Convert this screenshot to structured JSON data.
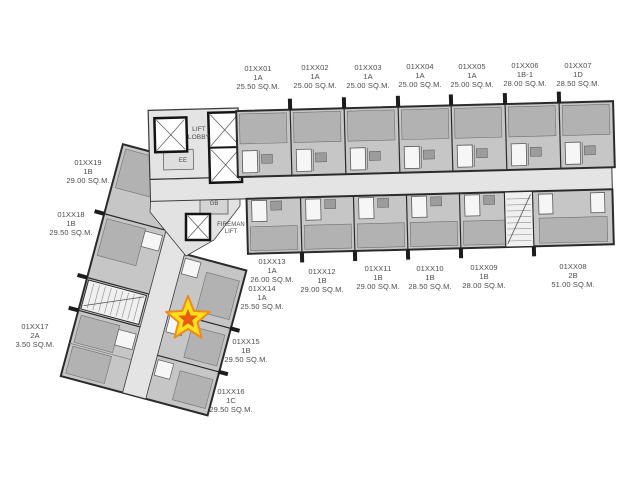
{
  "page": {
    "background": "#ffffff"
  },
  "palette": {
    "unit_fill": "#c6c6c6",
    "room_fill": "#b2b2b2",
    "corridor_fill": "#e4e4e4",
    "wall": "#2b2b2b",
    "text": "#4c4c4c"
  },
  "marker": {
    "shape": "star",
    "fill": "#ffe01a",
    "outline": "#f08a1d",
    "core": "#e85c12"
  },
  "core_labels": {
    "lift_lobby": "LIFT\nLOBBY",
    "fireman_lift": "FIREMAN\nLIFT",
    "ee": "EE",
    "gb": "GB"
  },
  "units": [
    {
      "id": "01XX01",
      "type": "1A",
      "area": "25.50 SQ.M."
    },
    {
      "id": "01XX02",
      "type": "1A",
      "area": "25.00 SQ.M."
    },
    {
      "id": "01XX03",
      "type": "1A",
      "area": "25.00 SQ.M."
    },
    {
      "id": "01XX04",
      "type": "1A",
      "area": "25.00 SQ.M."
    },
    {
      "id": "01XX05",
      "type": "1A",
      "area": "25.00 SQ.M."
    },
    {
      "id": "01XX06",
      "type": "1B-1",
      "area": "28.00 SQ.M."
    },
    {
      "id": "01XX07",
      "type": "1D",
      "area": "28.50 SQ.M."
    },
    {
      "id": "01XX08",
      "type": "2B",
      "area": "51.00 SQ.M."
    },
    {
      "id": "01XX09",
      "type": "1B",
      "area": "28.00 SQ.M."
    },
    {
      "id": "01XX10",
      "type": "1B",
      "area": "28.50 SQ.M."
    },
    {
      "id": "01XX11",
      "type": "1B",
      "area": "29.00 SQ.M."
    },
    {
      "id": "01XX12",
      "type": "1B",
      "area": "29.00 SQ.M."
    },
    {
      "id": "01XX13",
      "type": "1A",
      "area": "26.00 SQ.M."
    },
    {
      "id": "01XX14",
      "type": "1A",
      "area": "25.50 SQ.M."
    },
    {
      "id": "01XX15",
      "type": "1B",
      "area": "29.50 SQ.M."
    },
    {
      "id": "01XX16",
      "type": "1C",
      "area": "29.50 SQ.M."
    },
    {
      "id": "01XX17",
      "type": "2A",
      "area": "3.50 SQ.M."
    },
    {
      "id": "01XX18",
      "type": "1B",
      "area": "29.50 SQ.M."
    },
    {
      "id": "01XX19",
      "type": "1B",
      "area": "29.00 SQ.M."
    }
  ]
}
